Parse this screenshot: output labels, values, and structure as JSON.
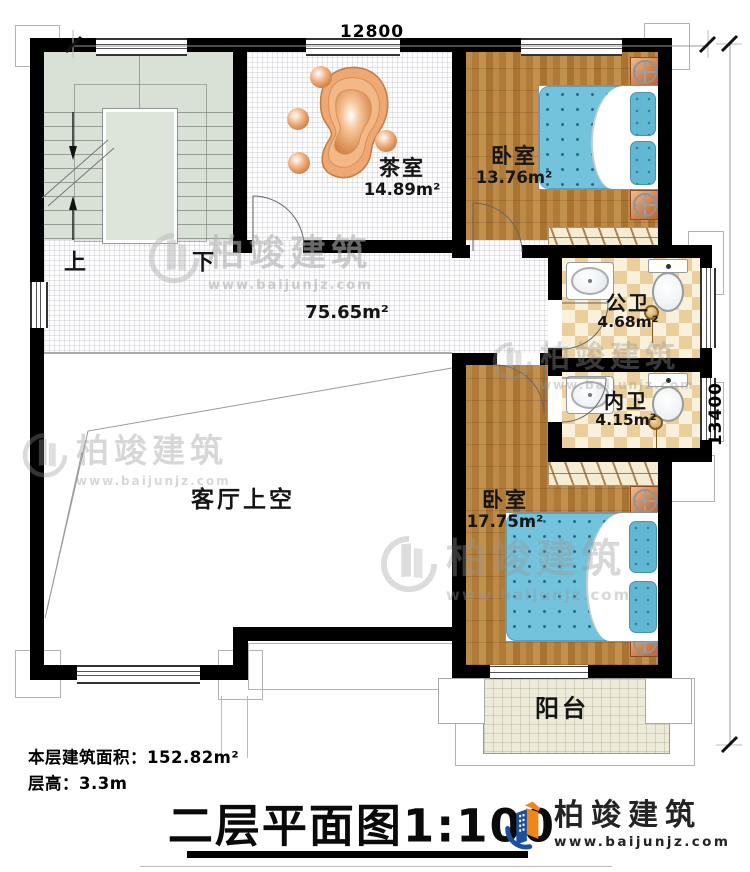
{
  "dimensions": {
    "top": "12800",
    "right": "13400"
  },
  "stairs": {
    "up": "上",
    "down": "下"
  },
  "rooms": {
    "tea": {
      "name": "茶室",
      "area": "14.89m²"
    },
    "bedroom1": {
      "name": "卧室",
      "area": "13.76m²"
    },
    "public_bath": {
      "name": "公卫",
      "area": "4.68m²"
    },
    "private_bath": {
      "name": "内卫",
      "area": "4.15m²"
    },
    "bedroom2": {
      "name": "卧室",
      "area": "17.75m²"
    },
    "corridor": {
      "area": "75.65m²"
    },
    "living_void": {
      "name": "客厅上空"
    },
    "balcony": {
      "name": "阳台"
    }
  },
  "info": {
    "area": "本层建筑面积：152.82m²",
    "height": "层高：3.3m"
  },
  "title": {
    "text": "二层平面图",
    "scale": "1:100"
  },
  "logo": {
    "name": "柏竣建筑",
    "url": "www.baijunjz.com"
  },
  "watermark": {
    "name": "柏竣建筑",
    "url": "www.baijunjz.com"
  },
  "colors": {
    "wall": "#000000",
    "wood": "#b07a38",
    "bed_blue": "#74c3dc",
    "bath_tile": "#eace9c",
    "stair_green": "#d9e0d6",
    "balcony": "#edead9",
    "logo_blue": "#1d4f9c",
    "logo_orange": "#f08519"
  }
}
